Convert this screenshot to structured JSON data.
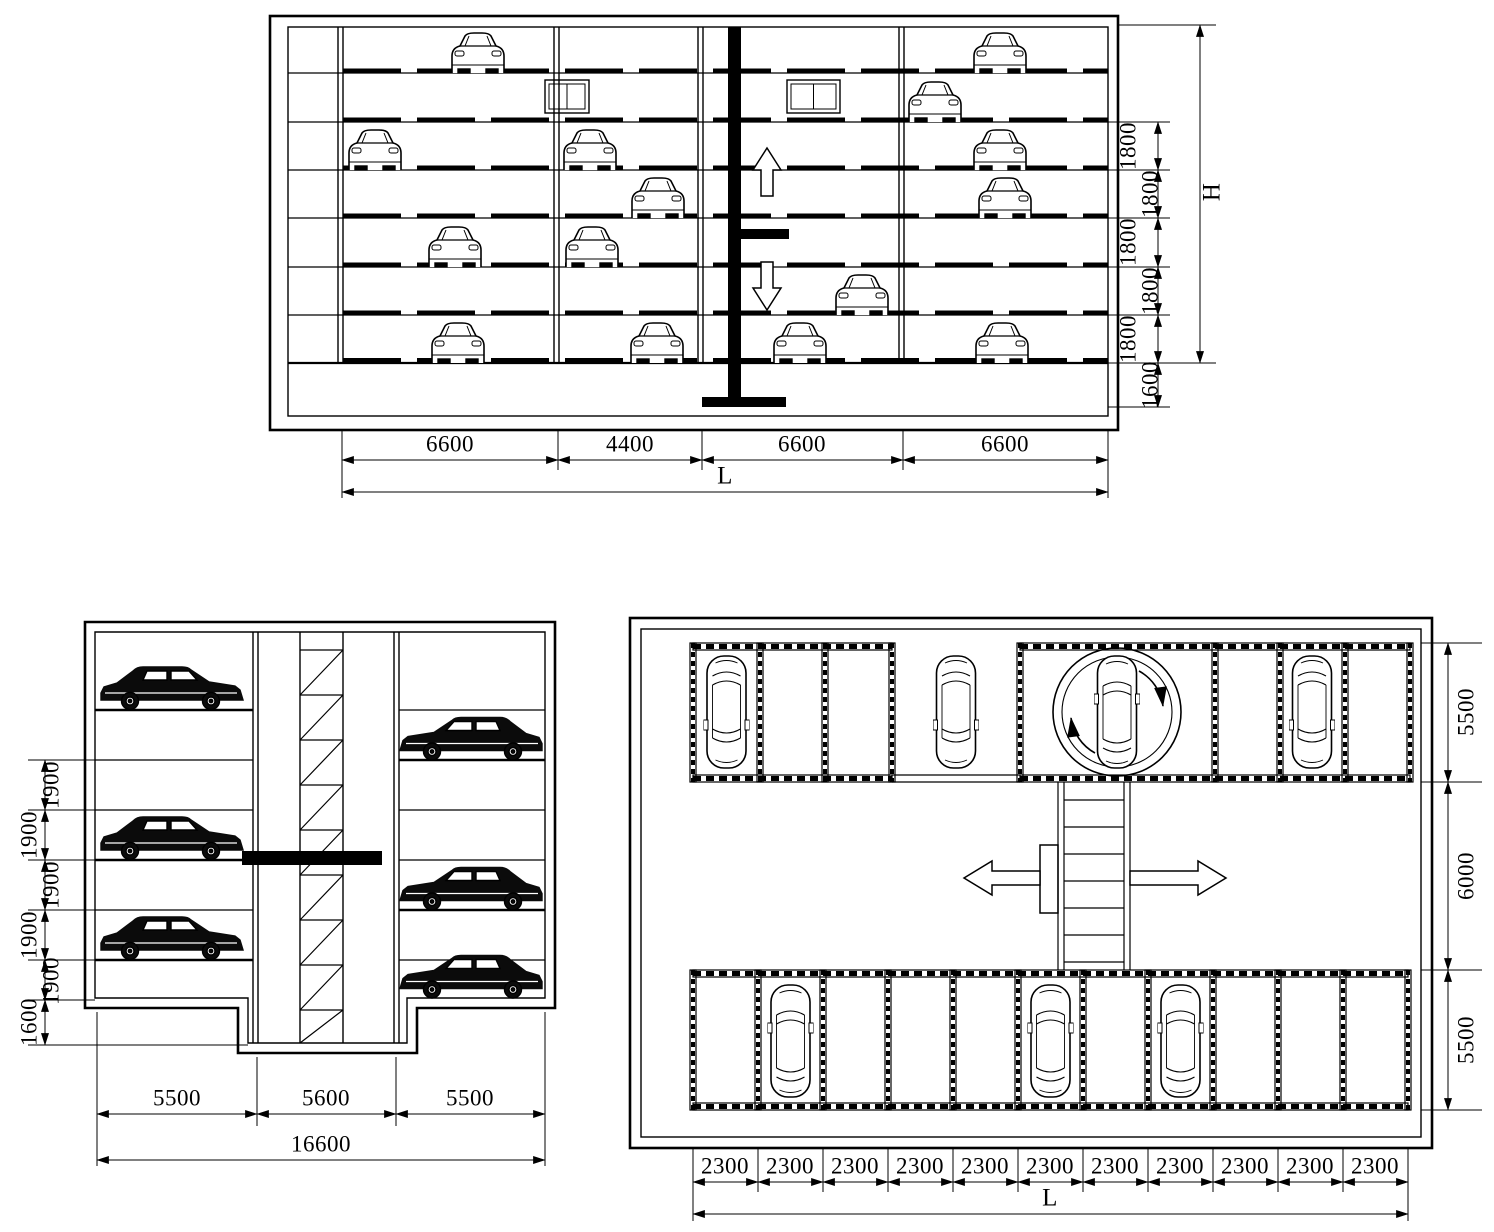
{
  "colors": {
    "background": "#ffffff",
    "line": "#000000"
  },
  "elevation_view": {
    "bottom_dims": [
      "6600",
      "4400",
      "6600",
      "6600"
    ],
    "total_label": "L",
    "right_dims": [
      "1800",
      "1800",
      "1800",
      "1800",
      "1800",
      "1600"
    ],
    "height_label": "H"
  },
  "side_view": {
    "left_dims": [
      "1900",
      "1900",
      "1900",
      "1900",
      "1900",
      "1600"
    ],
    "bottom_dims": [
      "5500",
      "5600",
      "5500"
    ],
    "total": "16600"
  },
  "plan_view": {
    "right_dims": [
      "5500",
      "6000",
      "5500"
    ],
    "bottom_dims": [
      "2300",
      "2300",
      "2300",
      "2300",
      "2300",
      "2300",
      "2300",
      "2300",
      "2300",
      "2300",
      "2300"
    ],
    "total_label": "L"
  }
}
